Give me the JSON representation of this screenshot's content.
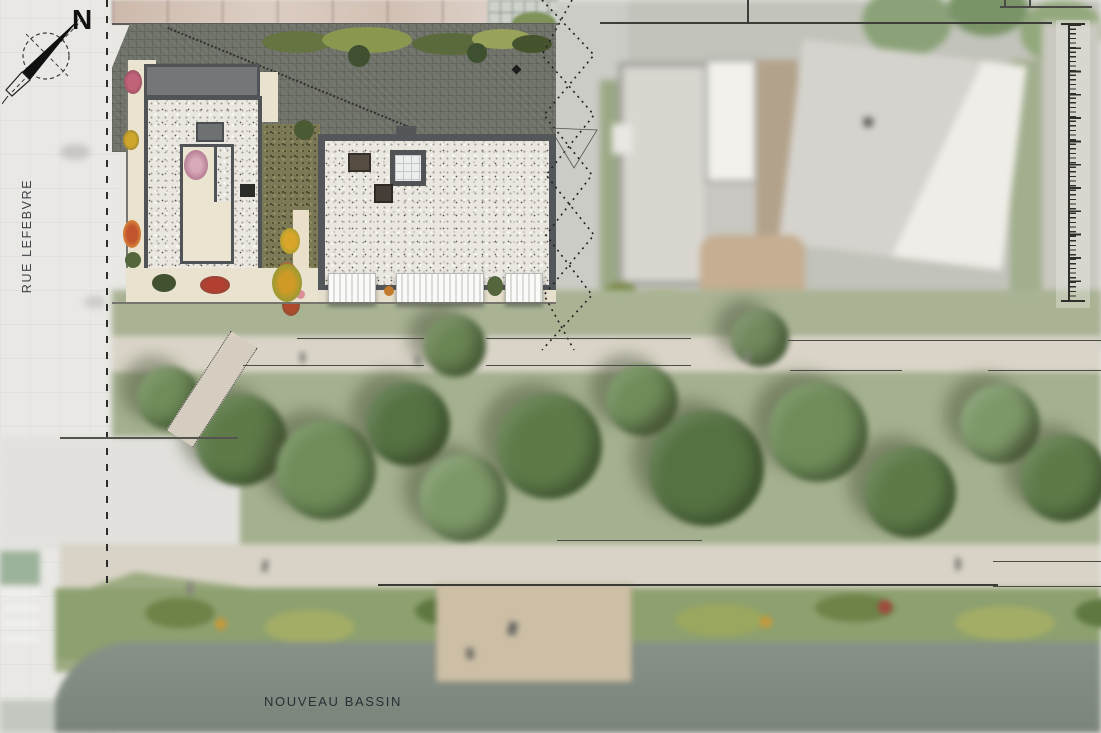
{
  "plan": {
    "title": "Architectural site plan - roof level view",
    "compass": {
      "north_label": "N"
    },
    "street_label": "RUE LEFEBVRE",
    "water_label": "NOUVEAU BASSIN",
    "palette": {
      "street": "#e9e8e5",
      "dark_pavement": "#6f7269",
      "parapet": "#54575a",
      "gravel_roof": "#e9e7e0",
      "terrace_cream": "#eae3d0",
      "green_roof": "#7c7957",
      "lawn": "#a4b08f",
      "tree_canopy": "#5d7a48",
      "path": "#d9d4c7",
      "water": "#8d988e",
      "sand": "#cdbfa5",
      "neighbor_facade": "#d0bcb0"
    }
  }
}
